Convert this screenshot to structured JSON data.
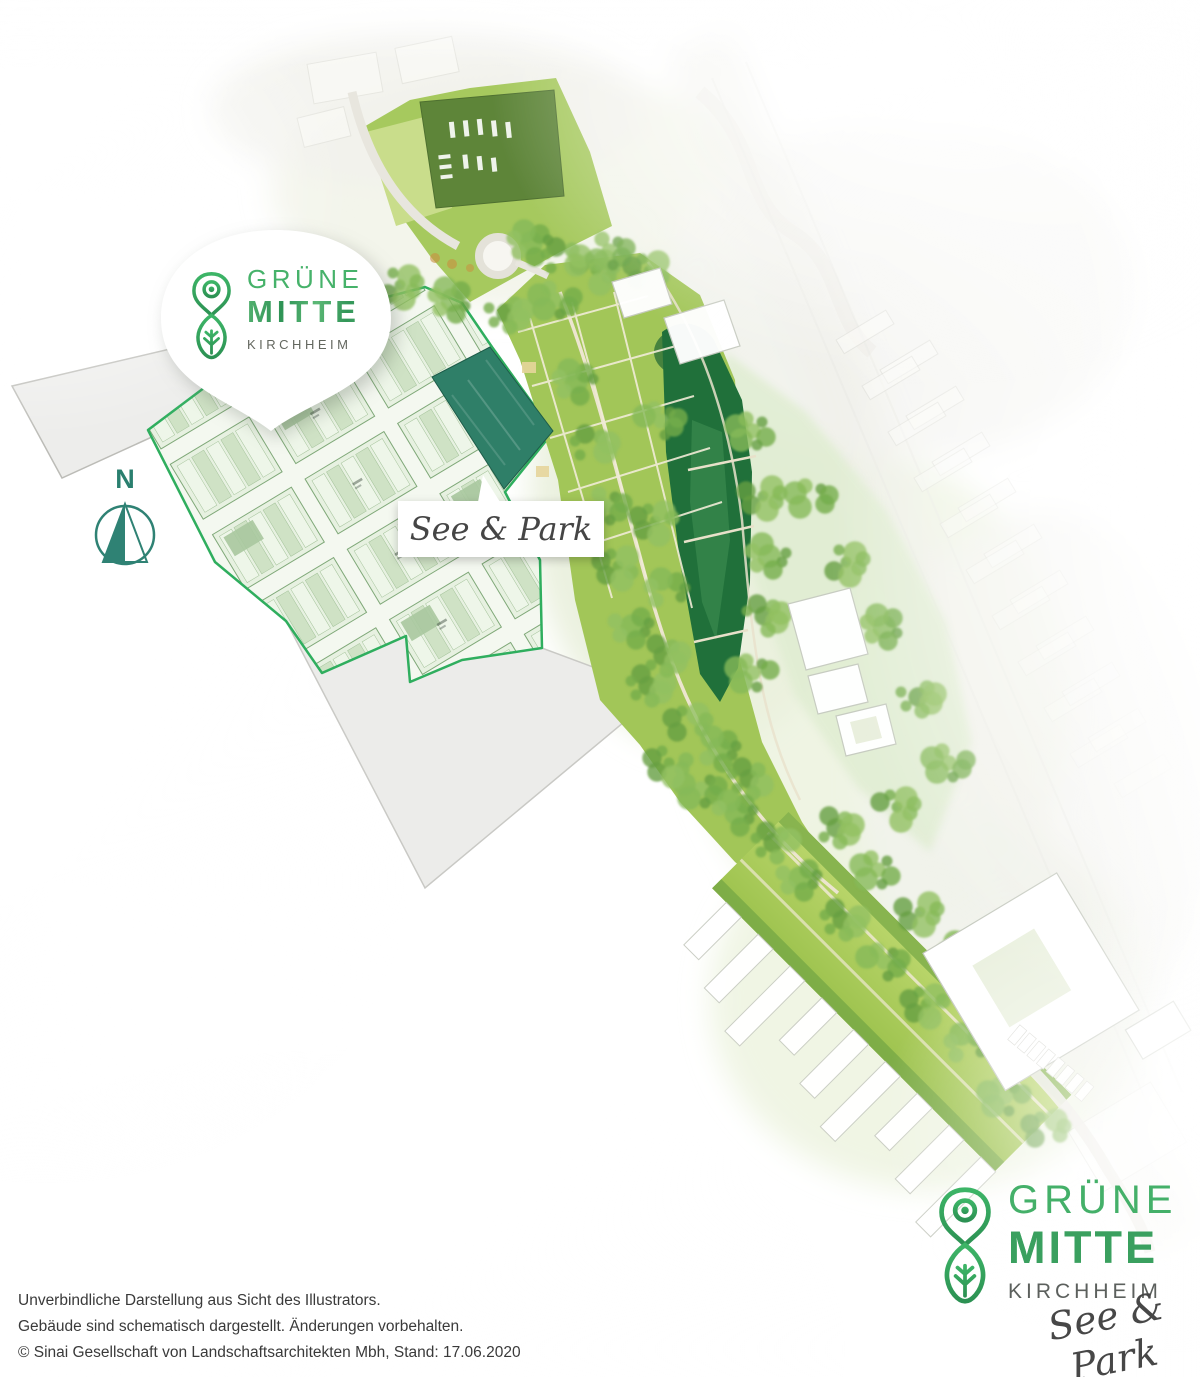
{
  "badge": {
    "brand_top": "GRÜNE",
    "brand_mid": "MITTE",
    "brand_bottom": "KIRCHHEIM"
  },
  "map": {
    "area_label": "See & Park",
    "compass_label": "N"
  },
  "logo": {
    "brand_top": "GRÜNE",
    "brand_mid": "MITTE",
    "brand_bottom": "KIRCHHEIM",
    "tagline": "See & Park"
  },
  "footer": {
    "line1": "Unverbindliche Darstellung aus Sicht des Illustrators.",
    "line2": "Gebäude sind schematisch dargestellt. Änderungen vorbehalten.",
    "line3": "© Sinai Gesellschaft von Landschaftsarchitekten Mbh, Stand: 17.06.2020"
  },
  "colors": {
    "brand_green": "#3fae64",
    "brand_teal": "#2a7f6f",
    "development_border": "#2fae5e",
    "see_park_building": "#2f7f68",
    "lake": "#20703a",
    "text_dark": "#3a3a3a",
    "text_gray": "#5c605d"
  }
}
